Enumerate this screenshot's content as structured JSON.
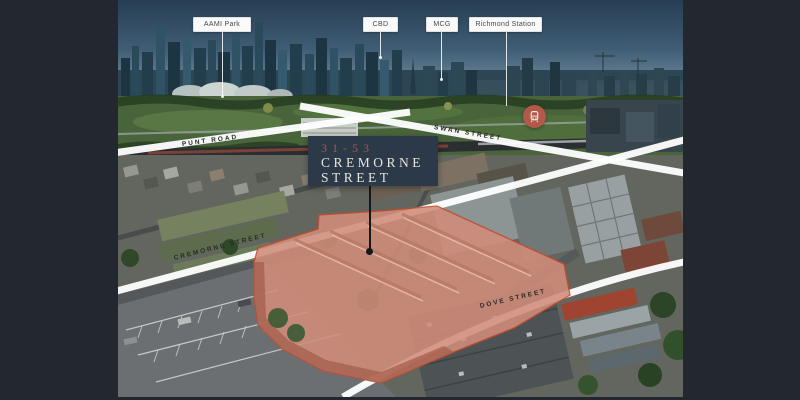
{
  "scene": {
    "description": "Aerial marketing photo of 31-53 Cremorne Street with Melbourne CBD skyline behind",
    "highlighted_property": "31-53 Cremorne Street"
  },
  "callouts": [
    {
      "label": "AAMI Park"
    },
    {
      "label": "CBD"
    },
    {
      "label": "MCG"
    },
    {
      "label": "Richmond Station",
      "icon": "train-icon"
    }
  ],
  "title_card": {
    "address_line": "31-53",
    "street_line1": "CREMORNE",
    "street_line2": "STREET"
  },
  "street_labels": [
    {
      "label": "PUNT ROAD"
    },
    {
      "label": "SWAN STREET"
    },
    {
      "label": "CREMORNE STREET"
    },
    {
      "label": "DOVE STREET"
    }
  ],
  "colors": {
    "frame_bg": "#232830",
    "title_bg": "#2c3949",
    "title_accent": "#a3594a",
    "title_text": "#e9e4d9",
    "highlight_fill": "#d18d7a",
    "highlight_outline": "#c44b2f",
    "station_marker": "#b2594a",
    "street_band": "#ffffff"
  }
}
